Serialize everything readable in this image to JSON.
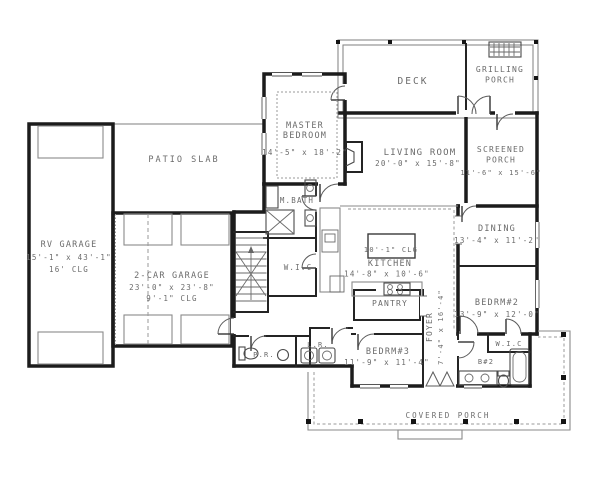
{
  "colors": {
    "background": "#ffffff",
    "wall": "#1c1c1c",
    "thin_line": "#8a8a8a",
    "label_text": "#6b6b6b"
  },
  "plan": {
    "deck": {
      "name": "DECK"
    },
    "grilling_porch": {
      "line1": "GRILLING",
      "line2": "PORCH"
    },
    "master_bedroom": {
      "line1": "MASTER",
      "line2": "BEDROOM",
      "dims": "14'-5\" x 18'-2\""
    },
    "living_room": {
      "name": "LIVING ROOM",
      "dims": "20'-0\" x 15'-8\""
    },
    "screened_porch": {
      "line1": "SCREENED",
      "line2": "PORCH",
      "dims": "11'-6\" x 15'-6\""
    },
    "dining": {
      "name": "DINING",
      "dims": "13'-4\" x 11'-2\""
    },
    "kitchen": {
      "name": "KITCHEN",
      "dims": "14'-8\" x 10'-6\"",
      "island_label": "10'-1\" CLG"
    },
    "pantry": {
      "name": "PANTRY"
    },
    "foyer": {
      "name": "FOYER",
      "dims": "7'-4\" x 16'-4\""
    },
    "bedroom2": {
      "name": "BEDRM#2",
      "dims": "13'-9\" x 12'-0\""
    },
    "bedroom3": {
      "name": "BEDRM#3",
      "dims": "11'-9\" x 11'-4\""
    },
    "wic_master": {
      "name": "W.I.C"
    },
    "wic_bedroom2": {
      "name": "W.I.C"
    },
    "bath2": {
      "name": "B#2"
    },
    "master_bath": {
      "name": "M.BATH"
    },
    "powder_room": {
      "name": "P.R."
    },
    "laundry_room": {
      "name": "L.R."
    },
    "patio": {
      "name": "PATIO SLAB"
    },
    "rv_garage": {
      "name": "RV GARAGE",
      "dims": "15'-1\" x 43'-1\"",
      "ceiling": "16' CLG"
    },
    "two_car_garage": {
      "name": "2-CAR GARAGE",
      "dims": "23'-0\" x 23'-8\"",
      "ceiling": "9'-1\" CLG"
    },
    "covered_porch": {
      "name": "COVERED PORCH"
    }
  }
}
